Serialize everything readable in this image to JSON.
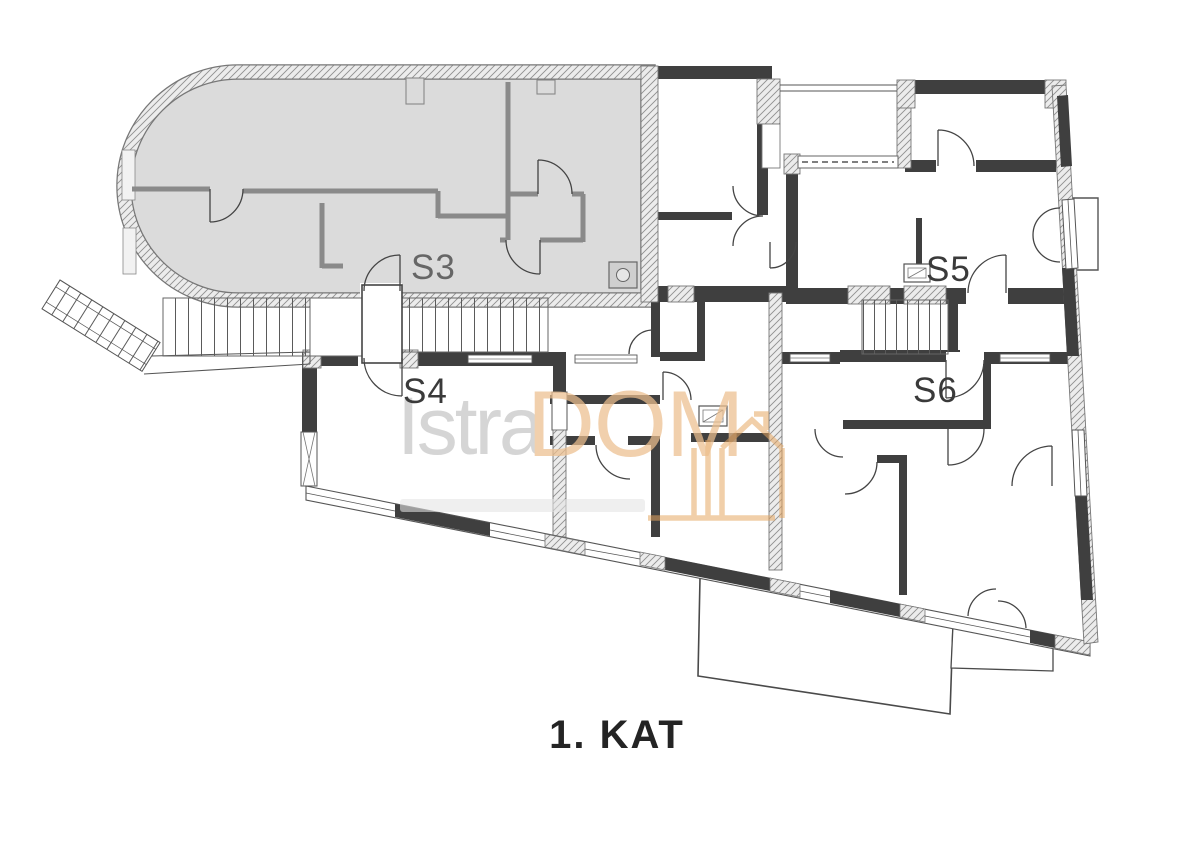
{
  "plan": {
    "floor_title": "1. KAT",
    "units": [
      {
        "id": "s3",
        "label": "S3",
        "highlighted": true
      },
      {
        "id": "s4",
        "label": "S4",
        "highlighted": false
      },
      {
        "id": "s5",
        "label": "S5",
        "highlighted": false
      },
      {
        "id": "s6",
        "label": "S6",
        "highlighted": false
      }
    ]
  },
  "watermark": {
    "brand_primary": "Istra",
    "brand_secondary": "DOM",
    "icon": "house-icon"
  },
  "colors": {
    "highlight_fill": "#dbdbdb",
    "wall_dark": "#3f3f3f",
    "wall_medium": "#8a8a8a",
    "line": "#4a4a4a",
    "watermark_gray": "#c6c6c6",
    "watermark_orange": "#edbf8e",
    "watermark_icon_orange": "#e6a660",
    "label_dark": "#3a3a3a",
    "label_light": "#666666"
  }
}
